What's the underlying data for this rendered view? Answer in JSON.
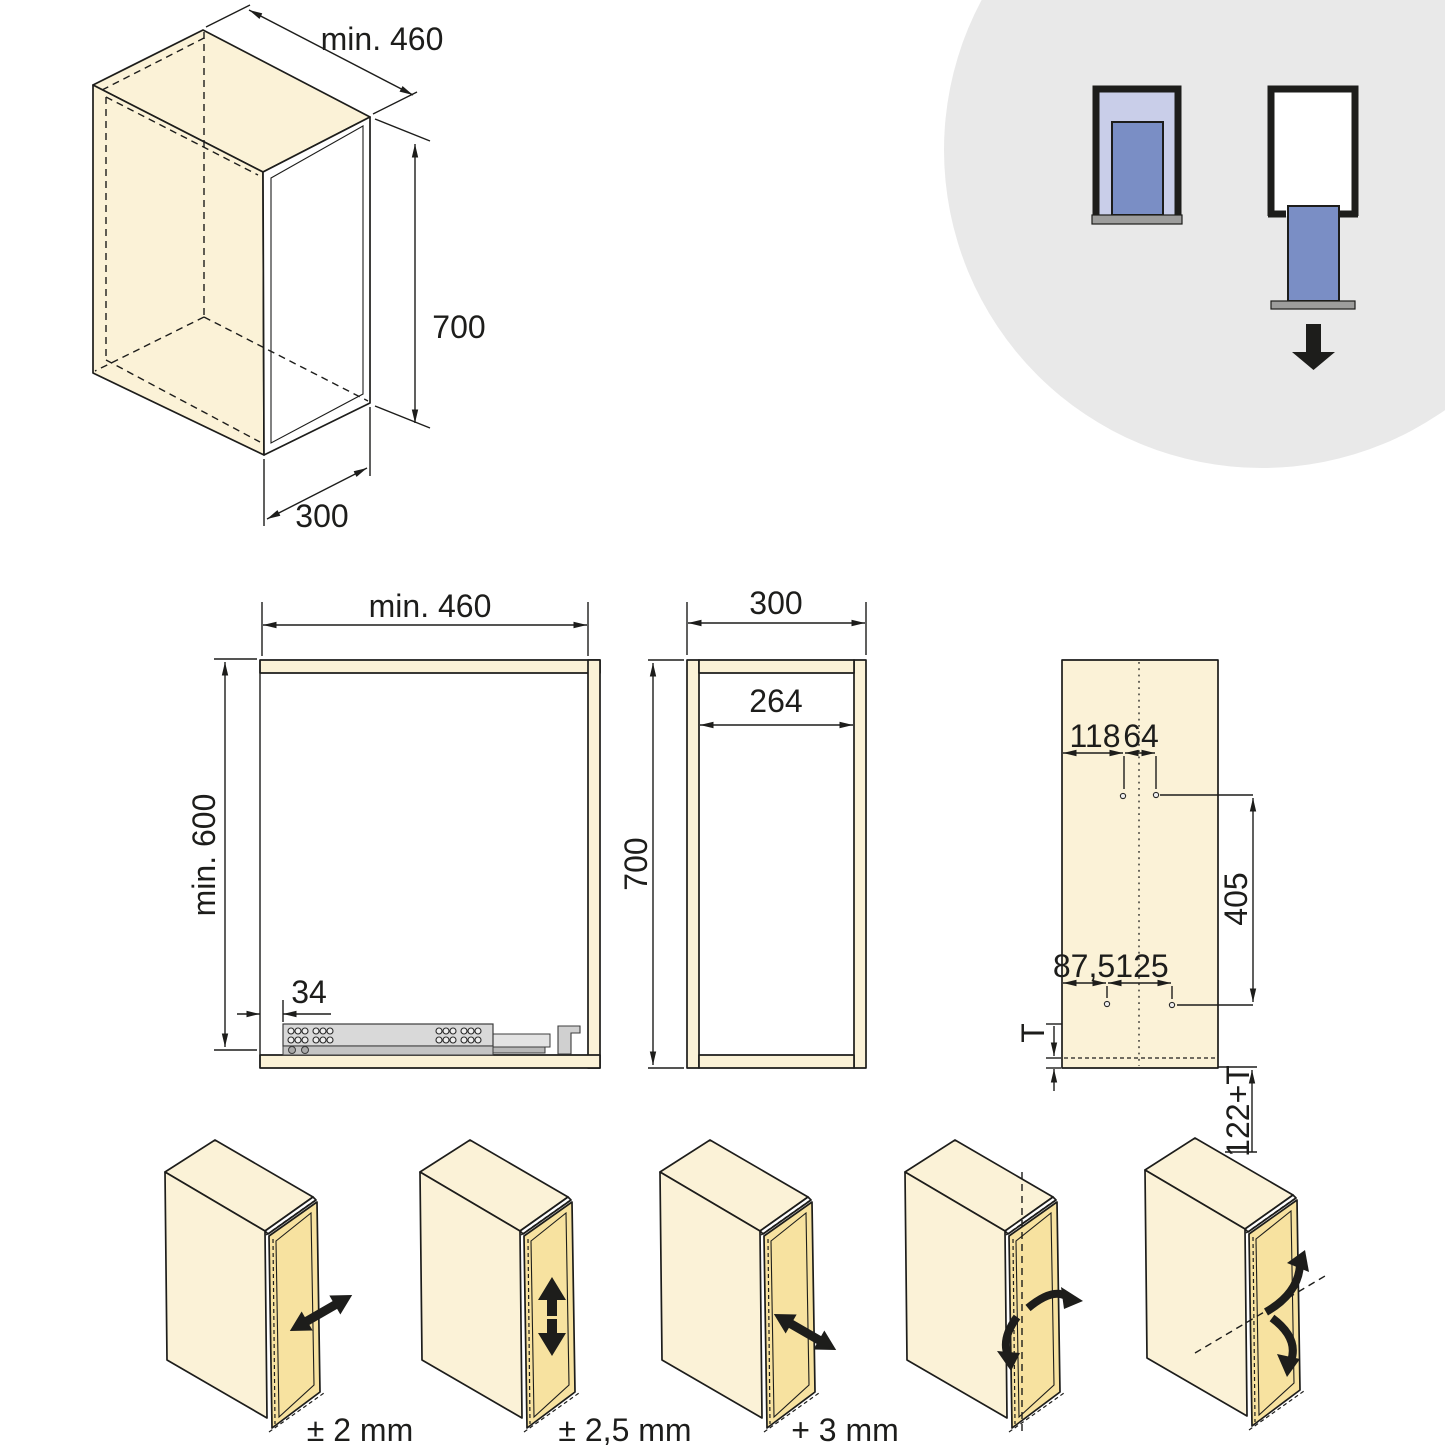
{
  "page": {
    "title": "Cabinet drawer-unit installation drawing"
  },
  "colors": {
    "line": "#1d1d1b",
    "panel_cream": "#fbf2d7",
    "frame_gold": "#f7e2a0",
    "circle_gray": "#e9e9e9",
    "icon_lavender": "#c9cee9",
    "icon_blue": "#7a8ec5",
    "icon_base_gray": "#9d9d9c",
    "slide_gray": "#d9d9d9"
  },
  "iso_view": {
    "depth_label": "min. 460",
    "height_label": "700",
    "width_label": "300"
  },
  "front_view": {
    "width_label": "min. 460",
    "height_label": "min. 600",
    "slide_offset_label": "34"
  },
  "side_view": {
    "width_label": "300",
    "inner_width_label": "264",
    "height_label": "700"
  },
  "drill_panel": {
    "front_offset_label": "118",
    "hole_gap_label": "64",
    "vertical_span_label": "405",
    "bottom_front_offset_label": "87,5",
    "bottom_gap_label": "125",
    "thickness_label": "T",
    "bottom_distance_label": "122+T"
  },
  "adjustments": {
    "items": [
      {
        "label": "± 2 mm"
      },
      {
        "label": "± 2,5 mm"
      },
      {
        "label": "+ 3 mm"
      }
    ]
  }
}
